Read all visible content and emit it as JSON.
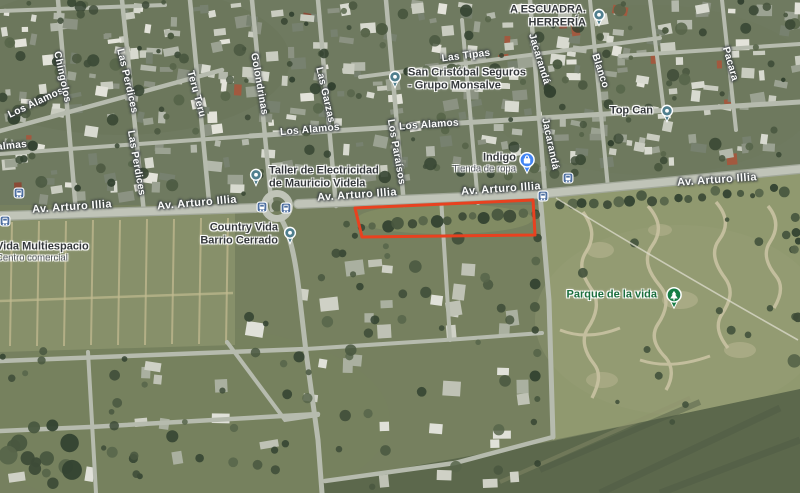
{
  "map_canvas": {
    "type": "satellite",
    "width": 800,
    "height": 493
  },
  "colors": {
    "property_outline": "#e8411f",
    "road_label": "#ffffff",
    "poi_label": "#34383b",
    "poi_sub_label": "#4f545a",
    "park_label": "#1b6e3d",
    "place_marker": "#507f8e",
    "shopping_marker": "#4285f4",
    "park_marker": "#167d45",
    "bus_icon": "#4e6fa0"
  },
  "road_labels": [
    {
      "text": "Av. Arturo Illia",
      "x": 72,
      "y": 207,
      "rot": -4,
      "big": true
    },
    {
      "text": "Av. Arturo Illia",
      "x": 197,
      "y": 203,
      "rot": -5,
      "big": true
    },
    {
      "text": "Av. Arturo Illia",
      "x": 357,
      "y": 195,
      "rot": -4,
      "big": true
    },
    {
      "text": "Av. Arturo Illia",
      "x": 501,
      "y": 189,
      "rot": -4,
      "big": true
    },
    {
      "text": "Av. Arturo Illia",
      "x": 717,
      "y": 180,
      "rot": -4,
      "big": true
    },
    {
      "text": "Los Alamos",
      "x": 36,
      "y": 103,
      "rot": -25,
      "big": false
    },
    {
      "text": "Los Alamos",
      "x": 310,
      "y": 130,
      "rot": -5,
      "big": false
    },
    {
      "text": "Los Alamos",
      "x": 429,
      "y": 125,
      "rot": -4,
      "big": false
    },
    {
      "text": "Las Tipas",
      "x": 466,
      "y": 56,
      "rot": -7,
      "big": false
    },
    {
      "text": "almas",
      "x": 12,
      "y": 146,
      "rot": -6,
      "big": false
    },
    {
      "text": "Chingolos",
      "x": 62,
      "y": 77,
      "rot": 78,
      "big": false
    },
    {
      "text": "Las Perdices",
      "x": 127,
      "y": 81,
      "rot": 77,
      "big": false
    },
    {
      "text": "Las Perdices",
      "x": 136,
      "y": 163,
      "rot": 80,
      "big": false
    },
    {
      "text": "Teru Teru",
      "x": 196,
      "y": 94,
      "rot": 75,
      "big": false
    },
    {
      "text": "Golondrinas",
      "x": 259,
      "y": 84,
      "rot": 80,
      "big": false
    },
    {
      "text": "Las Garzas",
      "x": 325,
      "y": 95,
      "rot": 77,
      "big": false
    },
    {
      "text": "Los Paraísos",
      "x": 396,
      "y": 152,
      "rot": 80,
      "big": false
    },
    {
      "text": "Jacarandá",
      "x": 539,
      "y": 59,
      "rot": 73,
      "big": false
    },
    {
      "text": "Jacarandá",
      "x": 550,
      "y": 144,
      "rot": 78,
      "big": false
    },
    {
      "text": "Blanco",
      "x": 600,
      "y": 71,
      "rot": 72,
      "big": false
    },
    {
      "text": "Pacara",
      "x": 730,
      "y": 64,
      "rot": 74,
      "big": false
    }
  ],
  "pois": [
    {
      "id": "escuadra-herreria",
      "lines": [
        "A ESCUADRA.",
        "HERRERÍA"
      ],
      "sub": null,
      "marker": "place",
      "mx": 599,
      "my": 15,
      "tx": 586,
      "ty": 16,
      "align": "right",
      "green": false
    },
    {
      "id": "san-cristobal-seguros",
      "lines": [
        "San Cristóbal Seguros",
        "- Grupo Monsalve"
      ],
      "sub": null,
      "marker": "place",
      "mx": 395,
      "my": 77,
      "tx": 408,
      "ty": 79,
      "align": "left",
      "green": false
    },
    {
      "id": "top-can",
      "lines": [
        "Top Can"
      ],
      "sub": null,
      "marker": "place",
      "mx": 667,
      "my": 111,
      "tx": 653,
      "ty": 111,
      "align": "right",
      "green": false
    },
    {
      "id": "indigo",
      "lines": [
        "Indigo"
      ],
      "sub": "Tienda de ropa",
      "marker": "shopping",
      "mx": 527,
      "my": 160,
      "tx": 516,
      "ty": 163,
      "align": "right",
      "green": false
    },
    {
      "id": "taller-electricidad",
      "lines": [
        "Taller de Electricidad",
        "de Mauricio Videla"
      ],
      "sub": null,
      "marker": "place",
      "mx": 256,
      "my": 175,
      "tx": 269,
      "ty": 177,
      "align": "left",
      "green": false
    },
    {
      "id": "country-vida",
      "lines": [
        "Country Vida",
        "Barrio Cerrado"
      ],
      "sub": null,
      "marker": "place",
      "mx": 290,
      "my": 233,
      "tx": 278,
      "ty": 234,
      "align": "right",
      "green": false
    },
    {
      "id": "parque-de-la-vida",
      "lines": [
        "Parque de la vida"
      ],
      "sub": null,
      "marker": "park",
      "mx": 674,
      "my": 295,
      "tx": 657,
      "ty": 295,
      "align": "right",
      "green": true
    },
    {
      "id": "vida-multiespacio",
      "lines": [
        "Vida Multiespacio"
      ],
      "sub": "Centro comercial",
      "marker": "none",
      "mx": null,
      "my": null,
      "tx": -4,
      "ty": 252,
      "align": "left",
      "green": false
    }
  ],
  "bus_stops": [
    {
      "x": 5,
      "y": 221
    },
    {
      "x": 19,
      "y": 193
    },
    {
      "x": 262,
      "y": 207
    },
    {
      "x": 286,
      "y": 208
    },
    {
      "x": 543,
      "y": 196
    },
    {
      "x": 568,
      "y": 178
    }
  ],
  "property_outline": {
    "points": [
      [
        355,
        208
      ],
      [
        533,
        200
      ],
      [
        535,
        235
      ],
      [
        362,
        237
      ]
    ]
  }
}
